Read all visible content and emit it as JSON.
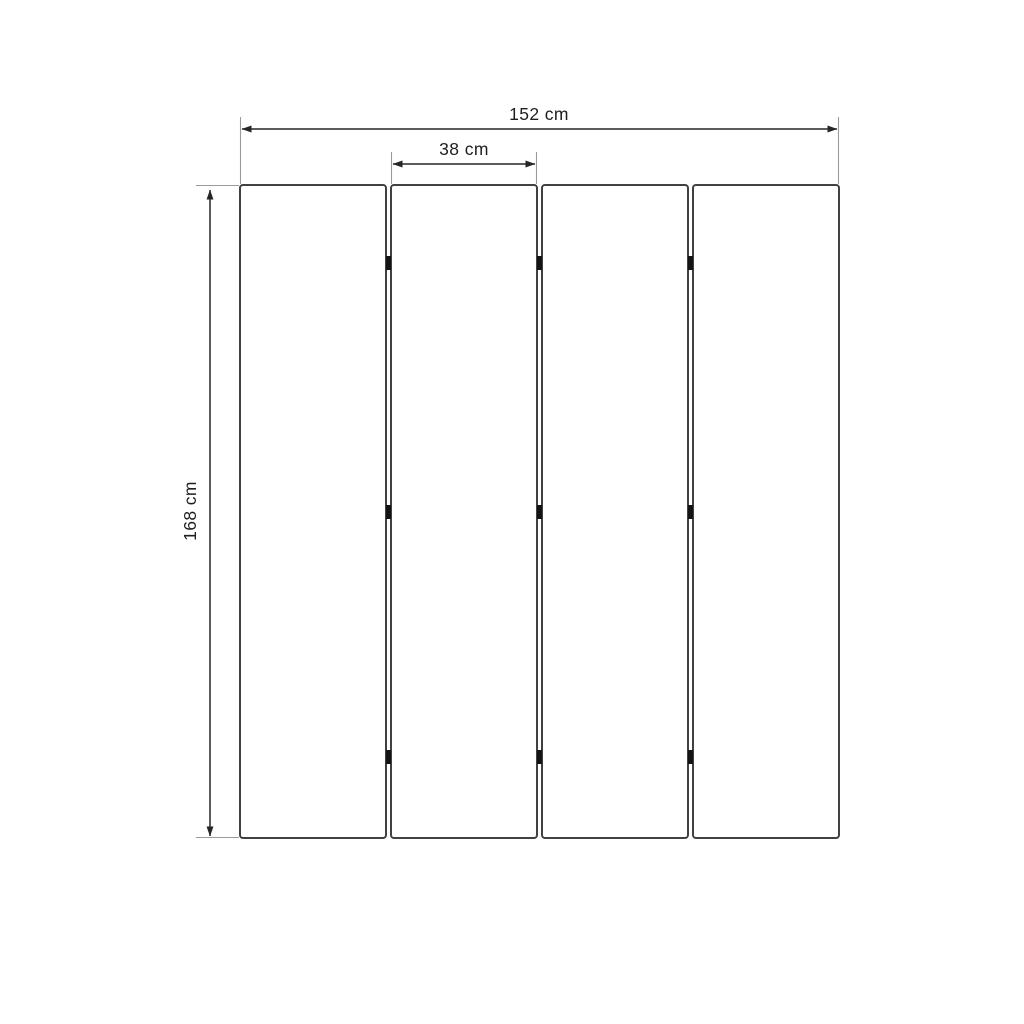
{
  "diagram": {
    "kind": "folding-screen-dimension-drawing",
    "panel_count": 4,
    "hinge_rows_per_gap": 3,
    "labels": {
      "total_width": "152 cm",
      "panel_width": "38 cm",
      "height": "168 cm"
    },
    "colors": {
      "background": "#ffffff",
      "panel_fill": "#ffffff",
      "panel_border": "#414141",
      "dimension_line": "#262626",
      "extension_line": "#9b9b9b",
      "hinge": "#141414",
      "text": "#1f1f1f"
    }
  }
}
